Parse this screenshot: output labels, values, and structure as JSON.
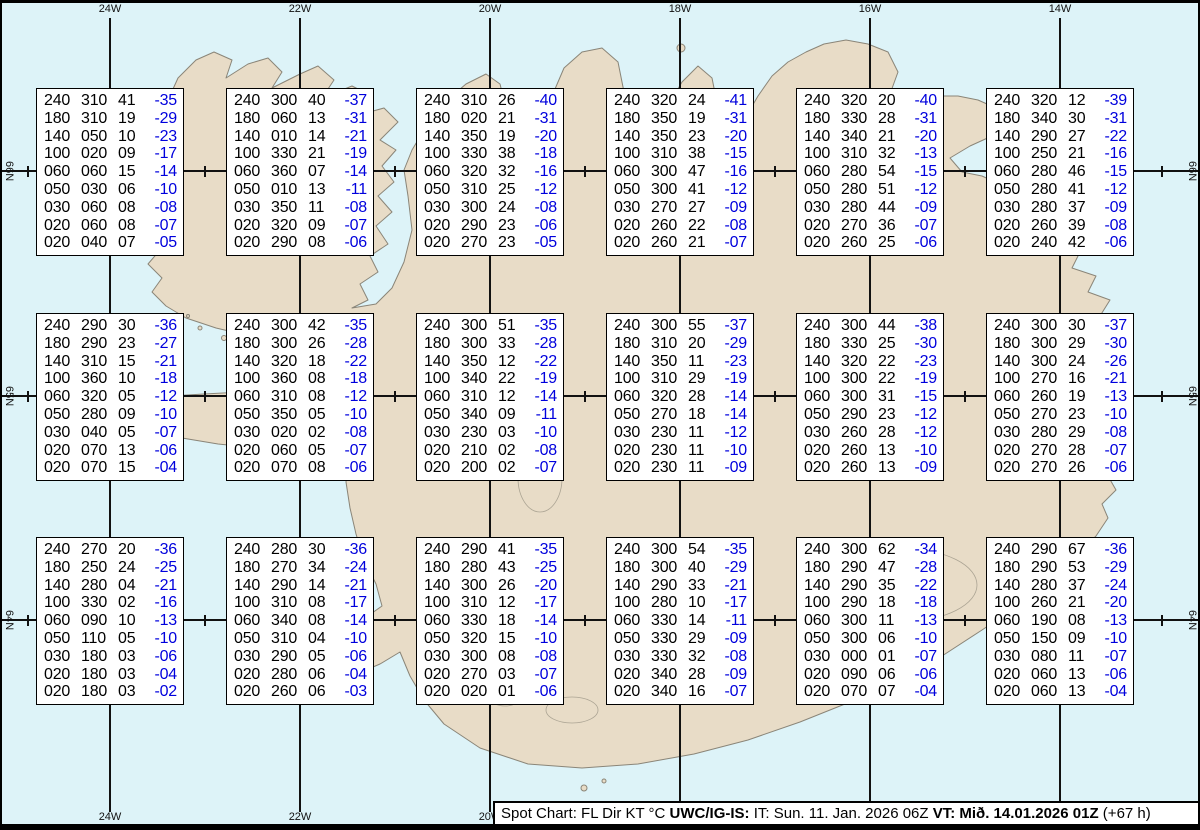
{
  "map": {
    "meridian_labels": [
      "24W",
      "22W",
      "20W",
      "18W",
      "16W",
      "14W"
    ],
    "parallel_labels": [
      "66N",
      "65N",
      "64N"
    ],
    "colors": {
      "water": "#ddf3f8",
      "land": "#e8dcc7",
      "coast": "#8a8578",
      "grid": "#111111",
      "temp": "#0000dd",
      "frame": "#000000"
    }
  },
  "boxes": [
    {
      "id": "r1c1",
      "rows": [
        [
          "240",
          "310",
          "41",
          "-35"
        ],
        [
          "180",
          "310",
          "19",
          "-29"
        ],
        [
          "140",
          "050",
          "10",
          "-23"
        ],
        [
          "100",
          "020",
          "09",
          "-17"
        ],
        [
          "060",
          "060",
          "15",
          "-14"
        ],
        [
          "050",
          "030",
          "06",
          "-10"
        ],
        [
          "030",
          "060",
          "08",
          "-08"
        ],
        [
          "020",
          "060",
          "08",
          "-07"
        ],
        [
          "020",
          "040",
          "07",
          "-05"
        ]
      ]
    },
    {
      "id": "r1c2",
      "rows": [
        [
          "240",
          "300",
          "40",
          "-37"
        ],
        [
          "180",
          "060",
          "13",
          "-31"
        ],
        [
          "140",
          "010",
          "14",
          "-21"
        ],
        [
          "100",
          "330",
          "21",
          "-19"
        ],
        [
          "060",
          "360",
          "07",
          "-14"
        ],
        [
          "050",
          "010",
          "13",
          "-11"
        ],
        [
          "030",
          "350",
          "11",
          "-08"
        ],
        [
          "020",
          "320",
          "09",
          "-07"
        ],
        [
          "020",
          "290",
          "08",
          "-06"
        ]
      ]
    },
    {
      "id": "r1c3",
      "rows": [
        [
          "240",
          "310",
          "26",
          "-40"
        ],
        [
          "180",
          "020",
          "21",
          "-31"
        ],
        [
          "140",
          "350",
          "19",
          "-20"
        ],
        [
          "100",
          "330",
          "38",
          "-18"
        ],
        [
          "060",
          "320",
          "32",
          "-16"
        ],
        [
          "050",
          "310",
          "25",
          "-12"
        ],
        [
          "030",
          "300",
          "24",
          "-08"
        ],
        [
          "020",
          "290",
          "23",
          "-06"
        ],
        [
          "020",
          "270",
          "23",
          "-05"
        ]
      ]
    },
    {
      "id": "r1c4",
      "rows": [
        [
          "240",
          "320",
          "24",
          "-41"
        ],
        [
          "180",
          "350",
          "19",
          "-31"
        ],
        [
          "140",
          "350",
          "23",
          "-20"
        ],
        [
          "100",
          "310",
          "38",
          "-15"
        ],
        [
          "060",
          "300",
          "47",
          "-16"
        ],
        [
          "050",
          "300",
          "41",
          "-12"
        ],
        [
          "030",
          "270",
          "27",
          "-09"
        ],
        [
          "020",
          "260",
          "22",
          "-08"
        ],
        [
          "020",
          "260",
          "21",
          "-07"
        ]
      ]
    },
    {
      "id": "r1c5",
      "rows": [
        [
          "240",
          "320",
          "20",
          "-40"
        ],
        [
          "180",
          "330",
          "28",
          "-31"
        ],
        [
          "140",
          "340",
          "21",
          "-20"
        ],
        [
          "100",
          "310",
          "32",
          "-13"
        ],
        [
          "060",
          "280",
          "54",
          "-15"
        ],
        [
          "050",
          "280",
          "51",
          "-12"
        ],
        [
          "030",
          "280",
          "44",
          "-09"
        ],
        [
          "020",
          "270",
          "36",
          "-07"
        ],
        [
          "020",
          "260",
          "25",
          "-06"
        ]
      ]
    },
    {
      "id": "r1c6",
      "rows": [
        [
          "240",
          "320",
          "12",
          "-39"
        ],
        [
          "180",
          "340",
          "30",
          "-31"
        ],
        [
          "140",
          "290",
          "27",
          "-22"
        ],
        [
          "100",
          "250",
          "21",
          "-16"
        ],
        [
          "060",
          "280",
          "46",
          "-15"
        ],
        [
          "050",
          "280",
          "41",
          "-12"
        ],
        [
          "030",
          "280",
          "37",
          "-09"
        ],
        [
          "020",
          "260",
          "39",
          "-08"
        ],
        [
          "020",
          "240",
          "42",
          "-06"
        ]
      ]
    },
    {
      "id": "r2c1",
      "rows": [
        [
          "240",
          "290",
          "30",
          "-36"
        ],
        [
          "180",
          "290",
          "23",
          "-27"
        ],
        [
          "140",
          "310",
          "15",
          "-21"
        ],
        [
          "100",
          "360",
          "10",
          "-18"
        ],
        [
          "060",
          "320",
          "05",
          "-12"
        ],
        [
          "050",
          "280",
          "09",
          "-10"
        ],
        [
          "030",
          "040",
          "05",
          "-07"
        ],
        [
          "020",
          "070",
          "13",
          "-06"
        ],
        [
          "020",
          "070",
          "15",
          "-04"
        ]
      ]
    },
    {
      "id": "r2c2",
      "rows": [
        [
          "240",
          "300",
          "42",
          "-35"
        ],
        [
          "180",
          "300",
          "26",
          "-28"
        ],
        [
          "140",
          "320",
          "18",
          "-22"
        ],
        [
          "100",
          "360",
          "08",
          "-18"
        ],
        [
          "060",
          "310",
          "08",
          "-12"
        ],
        [
          "050",
          "350",
          "05",
          "-10"
        ],
        [
          "030",
          "020",
          "02",
          "-08"
        ],
        [
          "020",
          "060",
          "05",
          "-07"
        ],
        [
          "020",
          "070",
          "08",
          "-06"
        ]
      ]
    },
    {
      "id": "r2c3",
      "rows": [
        [
          "240",
          "300",
          "51",
          "-35"
        ],
        [
          "180",
          "300",
          "33",
          "-28"
        ],
        [
          "140",
          "350",
          "12",
          "-22"
        ],
        [
          "100",
          "340",
          "22",
          "-19"
        ],
        [
          "060",
          "310",
          "12",
          "-14"
        ],
        [
          "050",
          "340",
          "09",
          "-11"
        ],
        [
          "030",
          "230",
          "03",
          "-10"
        ],
        [
          "020",
          "210",
          "02",
          "-08"
        ],
        [
          "020",
          "200",
          "02",
          "-07"
        ]
      ]
    },
    {
      "id": "r2c4",
      "rows": [
        [
          "240",
          "300",
          "55",
          "-37"
        ],
        [
          "180",
          "310",
          "20",
          "-29"
        ],
        [
          "140",
          "350",
          "11",
          "-23"
        ],
        [
          "100",
          "310",
          "29",
          "-19"
        ],
        [
          "060",
          "320",
          "28",
          "-14"
        ],
        [
          "050",
          "270",
          "18",
          "-14"
        ],
        [
          "030",
          "230",
          "11",
          "-12"
        ],
        [
          "020",
          "230",
          "11",
          "-10"
        ],
        [
          "020",
          "230",
          "11",
          "-09"
        ]
      ]
    },
    {
      "id": "r2c5",
      "rows": [
        [
          "240",
          "300",
          "44",
          "-38"
        ],
        [
          "180",
          "330",
          "25",
          "-30"
        ],
        [
          "140",
          "320",
          "22",
          "-23"
        ],
        [
          "100",
          "300",
          "22",
          "-19"
        ],
        [
          "060",
          "300",
          "31",
          "-15"
        ],
        [
          "050",
          "290",
          "23",
          "-12"
        ],
        [
          "030",
          "260",
          "28",
          "-12"
        ],
        [
          "020",
          "260",
          "13",
          "-10"
        ],
        [
          "020",
          "260",
          "13",
          "-09"
        ]
      ]
    },
    {
      "id": "r2c6",
      "rows": [
        [
          "240",
          "300",
          "30",
          "-37"
        ],
        [
          "180",
          "300",
          "29",
          "-30"
        ],
        [
          "140",
          "300",
          "24",
          "-26"
        ],
        [
          "100",
          "270",
          "16",
          "-21"
        ],
        [
          "060",
          "260",
          "19",
          "-13"
        ],
        [
          "050",
          "270",
          "23",
          "-10"
        ],
        [
          "030",
          "280",
          "29",
          "-08"
        ],
        [
          "020",
          "270",
          "28",
          "-07"
        ],
        [
          "020",
          "270",
          "26",
          "-06"
        ]
      ]
    },
    {
      "id": "r3c1",
      "rows": [
        [
          "240",
          "270",
          "20",
          "-36"
        ],
        [
          "180",
          "250",
          "24",
          "-25"
        ],
        [
          "140",
          "280",
          "04",
          "-21"
        ],
        [
          "100",
          "330",
          "02",
          "-16"
        ],
        [
          "060",
          "090",
          "10",
          "-13"
        ],
        [
          "050",
          "110",
          "05",
          "-10"
        ],
        [
          "030",
          "180",
          "03",
          "-06"
        ],
        [
          "020",
          "180",
          "03",
          "-04"
        ],
        [
          "020",
          "180",
          "03",
          "-02"
        ]
      ]
    },
    {
      "id": "r3c2",
      "rows": [
        [
          "240",
          "280",
          "30",
          "-36"
        ],
        [
          "180",
          "270",
          "34",
          "-24"
        ],
        [
          "140",
          "290",
          "14",
          "-21"
        ],
        [
          "100",
          "310",
          "08",
          "-17"
        ],
        [
          "060",
          "340",
          "08",
          "-14"
        ],
        [
          "050",
          "310",
          "04",
          "-10"
        ],
        [
          "030",
          "290",
          "05",
          "-06"
        ],
        [
          "020",
          "280",
          "06",
          "-04"
        ],
        [
          "020",
          "260",
          "06",
          "-03"
        ]
      ]
    },
    {
      "id": "r3c3",
      "rows": [
        [
          "240",
          "290",
          "41",
          "-35"
        ],
        [
          "180",
          "280",
          "43",
          "-25"
        ],
        [
          "140",
          "300",
          "26",
          "-20"
        ],
        [
          "100",
          "310",
          "12",
          "-17"
        ],
        [
          "060",
          "330",
          "18",
          "-14"
        ],
        [
          "050",
          "320",
          "15",
          "-10"
        ],
        [
          "030",
          "300",
          "08",
          "-08"
        ],
        [
          "020",
          "270",
          "03",
          "-07"
        ],
        [
          "020",
          "020",
          "01",
          "-06"
        ]
      ]
    },
    {
      "id": "r3c4",
      "rows": [
        [
          "240",
          "300",
          "54",
          "-35"
        ],
        [
          "180",
          "300",
          "40",
          "-29"
        ],
        [
          "140",
          "290",
          "33",
          "-21"
        ],
        [
          "100",
          "280",
          "10",
          "-17"
        ],
        [
          "060",
          "330",
          "14",
          "-11"
        ],
        [
          "050",
          "330",
          "29",
          "-09"
        ],
        [
          "030",
          "330",
          "32",
          "-08"
        ],
        [
          "020",
          "340",
          "28",
          "-09"
        ],
        [
          "020",
          "340",
          "16",
          "-07"
        ]
      ]
    },
    {
      "id": "r3c5",
      "rows": [
        [
          "240",
          "300",
          "62",
          "-34"
        ],
        [
          "180",
          "290",
          "47",
          "-28"
        ],
        [
          "140",
          "290",
          "35",
          "-22"
        ],
        [
          "100",
          "290",
          "18",
          "-18"
        ],
        [
          "060",
          "300",
          "11",
          "-13"
        ],
        [
          "050",
          "300",
          "06",
          "-10"
        ],
        [
          "030",
          "000",
          "01",
          "-07"
        ],
        [
          "020",
          "090",
          "06",
          "-06"
        ],
        [
          "020",
          "070",
          "07",
          "-04"
        ]
      ]
    },
    {
      "id": "r3c6",
      "rows": [
        [
          "240",
          "290",
          "67",
          "-36"
        ],
        [
          "180",
          "290",
          "53",
          "-29"
        ],
        [
          "140",
          "280",
          "37",
          "-24"
        ],
        [
          "100",
          "260",
          "21",
          "-20"
        ],
        [
          "060",
          "190",
          "08",
          "-13"
        ],
        [
          "050",
          "150",
          "09",
          "-10"
        ],
        [
          "030",
          "080",
          "11",
          "-07"
        ],
        [
          "020",
          "060",
          "13",
          "-06"
        ],
        [
          "020",
          "060",
          "13",
          "-04"
        ]
      ]
    }
  ],
  "footer": {
    "prefix": "Spot Chart: FL Dir KT °C ",
    "product": "UWC/IG-IS:",
    "issued": " IT: Sun. 11. Jan. 2026 06Z ",
    "valid": "VT: Mið. 14.01.2026 01Z",
    "lead": " (+67 h)"
  }
}
